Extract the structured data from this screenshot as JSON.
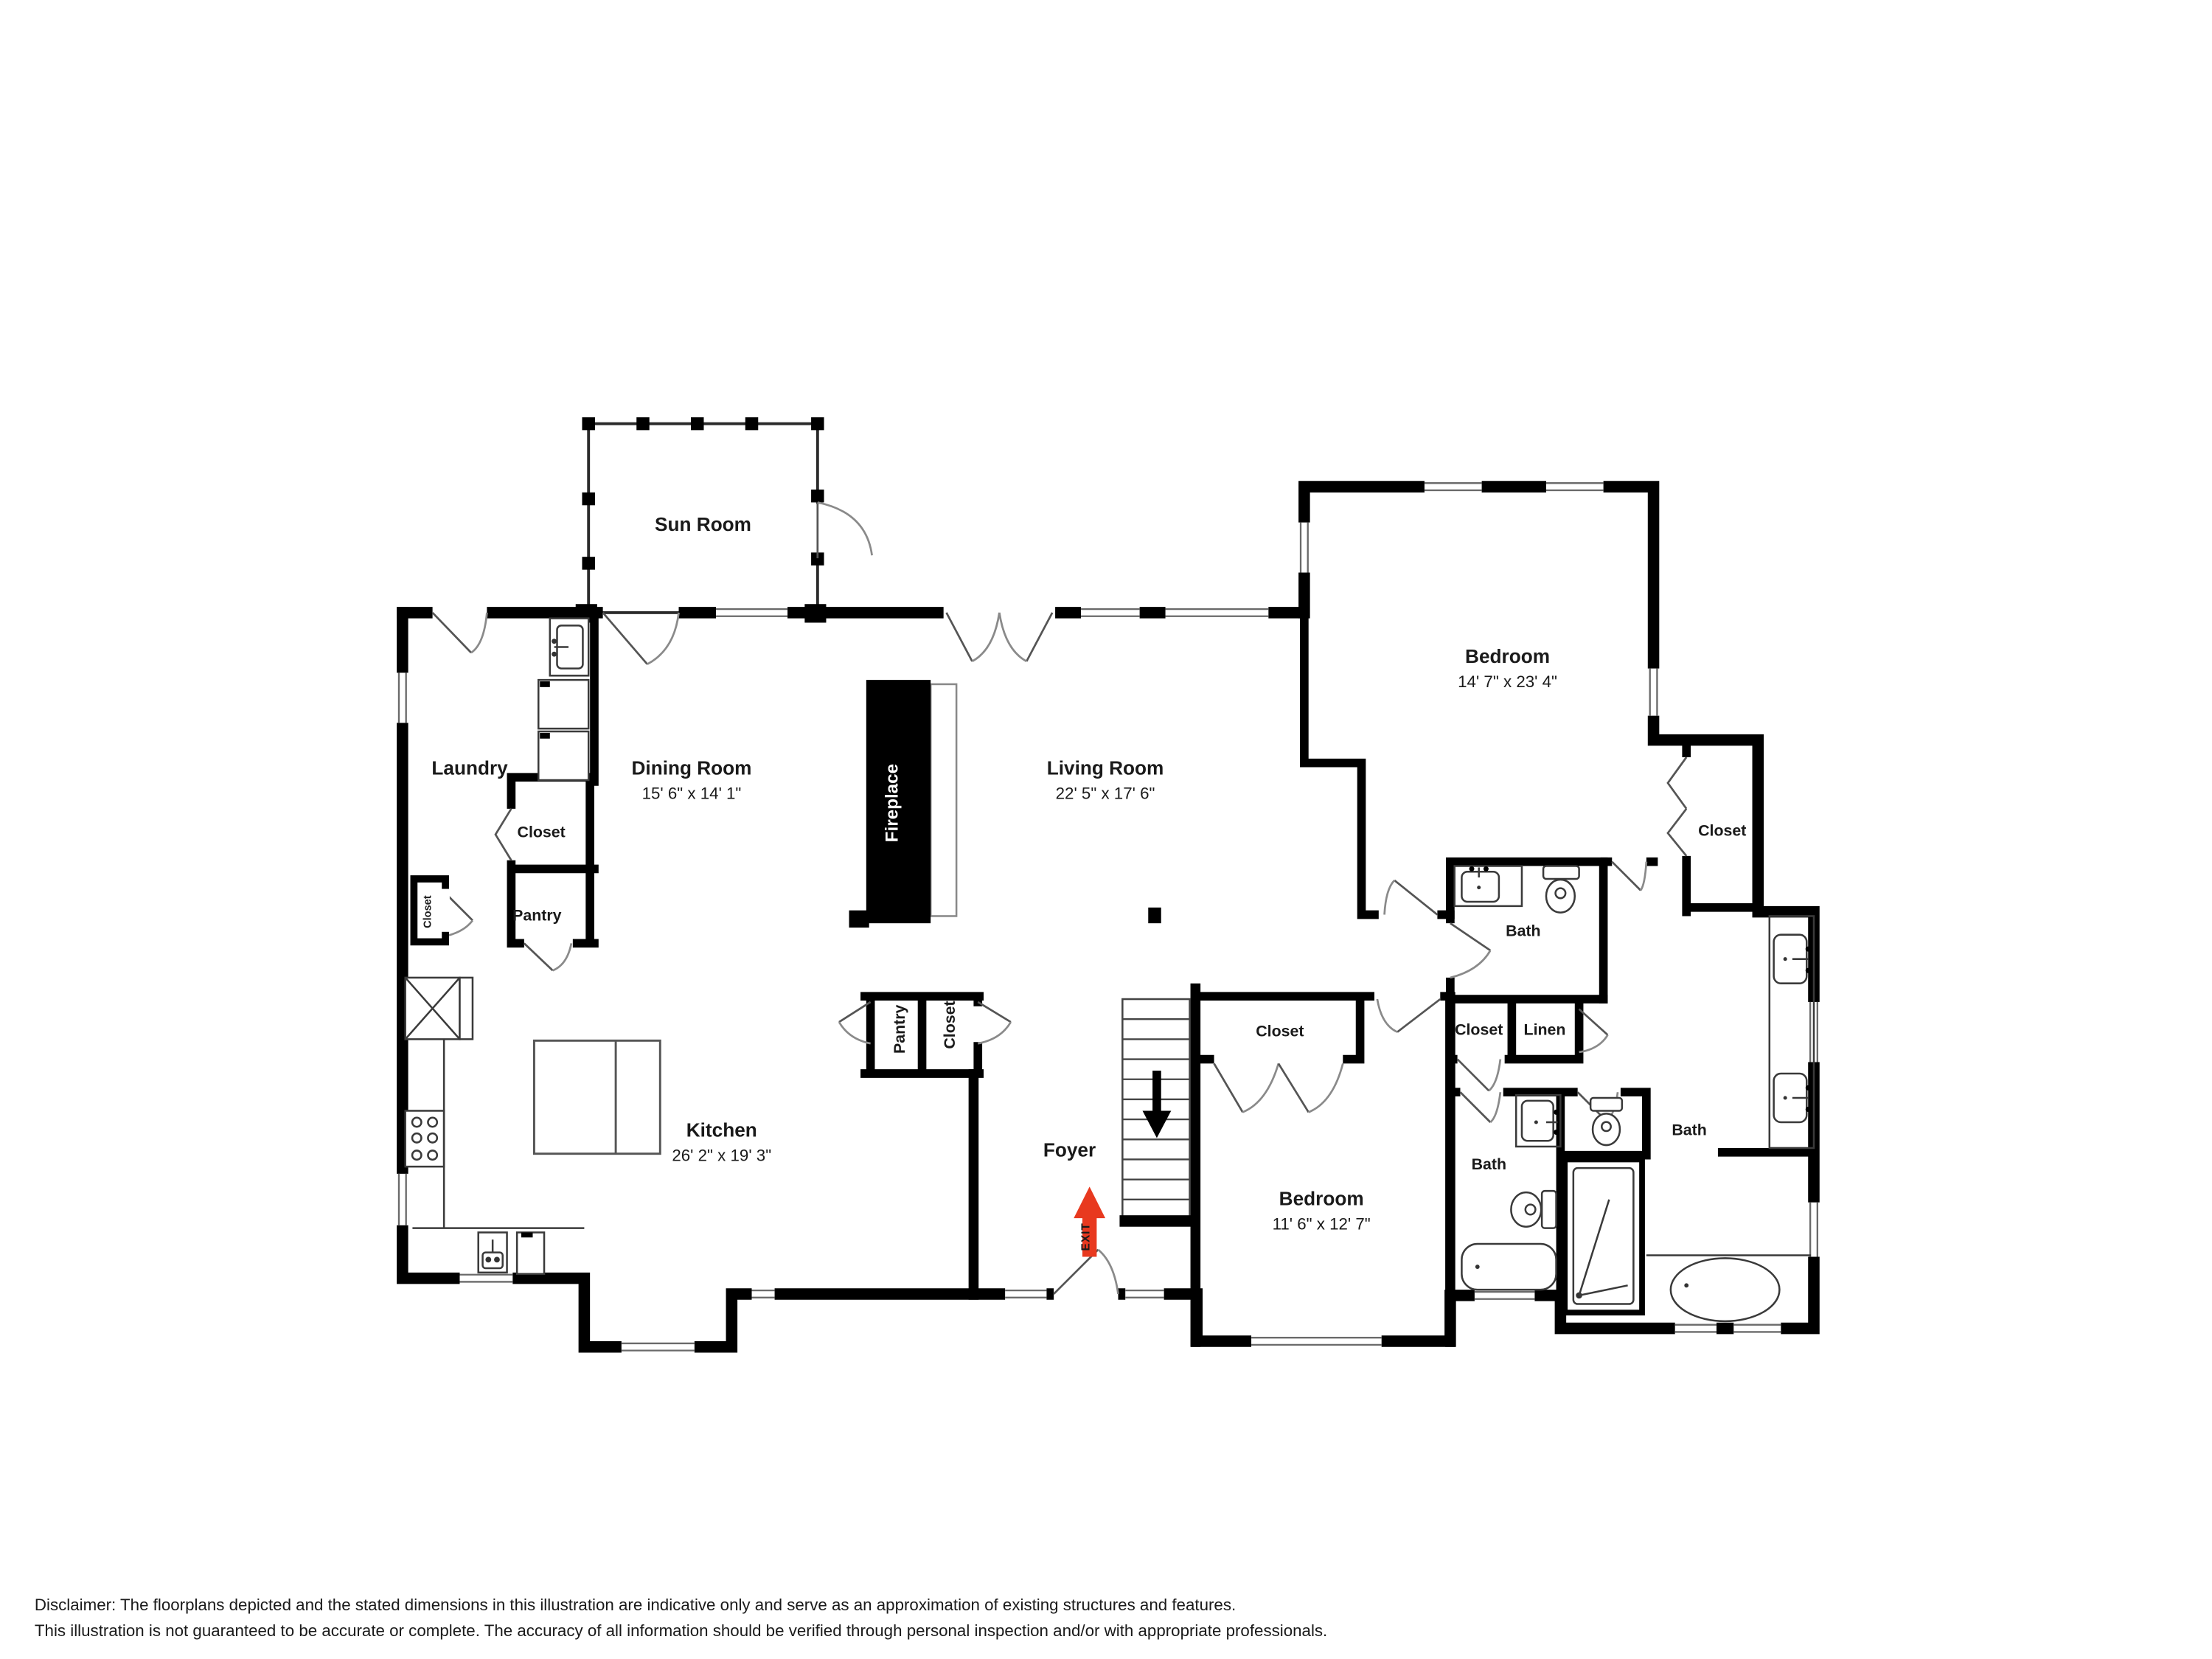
{
  "labels": {
    "sun_room": "Sun Room",
    "laundry": "Laundry",
    "dining_room": "Dining Room",
    "dining_dims": "15' 6\" x 14' 1\"",
    "living_room": "Living Room",
    "living_dims": "22' 5\" x 17' 6\"",
    "kitchen": "Kitchen",
    "kitchen_dims": "26' 2\" x 19' 3\"",
    "bedroom_main": "Bedroom",
    "bedroom_main_dims": "14' 7\" x 23' 4\"",
    "bedroom_second": "Bedroom",
    "bedroom_second_dims": "11' 6\" x 12' 7\"",
    "foyer": "Foyer",
    "fireplace": "Fireplace",
    "exit": "EXIT",
    "bath_hall": "Bath",
    "bath_second": "Bath",
    "bath_master": "Bath",
    "closet_laundry": "Closet",
    "pantry_laundry": "Pantry",
    "closet_left_wall": "Closet",
    "closet_master": "Closet",
    "closet_hall_small": "Closet",
    "linen": "Linen",
    "closet_bedroom": "Closet",
    "pantry_foyer": "Pantry",
    "closet_foyer": "Closet"
  },
  "disclaimer": {
    "line1": "Disclaimer: The floorplans depicted and the stated dimensions in this illustration are indicative only and serve as an approximation of existing structures and features.",
    "line2": "This illustration is not guaranteed to be accurate or complete. The accuracy of all information should be verified through personal inspection and/or with appropriate professionals."
  },
  "colors": {
    "walls": "#000000",
    "exit_arrow": "#e8391f",
    "disclaimer_text": "#b2b7c2"
  }
}
